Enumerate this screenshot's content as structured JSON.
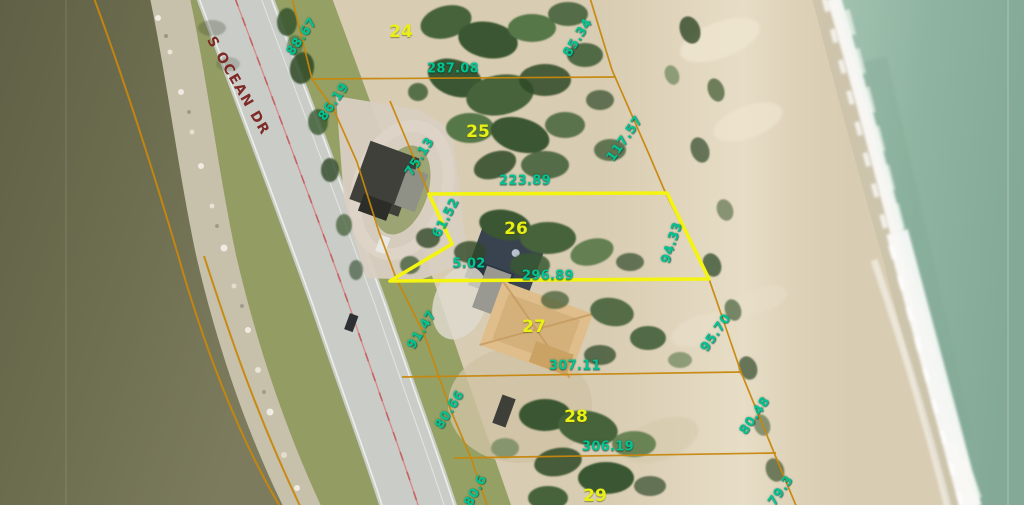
{
  "map": {
    "description": "aerial-parcel-map",
    "selected_parcel": "26"
  },
  "labels": {
    "road": {
      "text": "S OCEAN DR",
      "x": 238,
      "y": 86,
      "rot": 60
    },
    "parcels": [
      {
        "text": "24",
        "x": 401,
        "y": 32
      },
      {
        "text": "25",
        "x": 478,
        "y": 132
      },
      {
        "text": "26",
        "x": 516,
        "y": 229
      },
      {
        "text": "27",
        "x": 534,
        "y": 327
      },
      {
        "text": "28",
        "x": 576,
        "y": 417
      },
      {
        "text": "29",
        "x": 595,
        "y": 496
      }
    ],
    "dimensions": [
      {
        "text": "88.67",
        "x": 302,
        "y": 37,
        "rot": -55
      },
      {
        "text": "86.19",
        "x": 334,
        "y": 102,
        "rot": -55
      },
      {
        "text": "287.08",
        "x": 453,
        "y": 69,
        "rot": 0
      },
      {
        "text": "85.34",
        "x": 578,
        "y": 38,
        "rot": -58
      },
      {
        "text": "117.57",
        "x": 625,
        "y": 139,
        "rot": -55
      },
      {
        "text": "75.13",
        "x": 420,
        "y": 157,
        "rot": -58
      },
      {
        "text": "223.89",
        "x": 525,
        "y": 181,
        "rot": 0
      },
      {
        "text": "61.52",
        "x": 446,
        "y": 218,
        "rot": -62
      },
      {
        "text": "94.33",
        "x": 672,
        "y": 243,
        "rot": -72
      },
      {
        "text": "5.02",
        "x": 469,
        "y": 264,
        "rot": 0
      },
      {
        "text": "296.89",
        "x": 548,
        "y": 276,
        "rot": 0
      },
      {
        "text": "91.47",
        "x": 422,
        "y": 330,
        "rot": -58
      },
      {
        "text": "95.70",
        "x": 716,
        "y": 333,
        "rot": -55
      },
      {
        "text": "307.11",
        "x": 575,
        "y": 366,
        "rot": 0
      },
      {
        "text": "80.66",
        "x": 450,
        "y": 410,
        "rot": -58
      },
      {
        "text": "80.48",
        "x": 755,
        "y": 416,
        "rot": -55
      },
      {
        "text": "306.19",
        "x": 608,
        "y": 447,
        "rot": 0
      },
      {
        "text": "80.6",
        "x": 476,
        "y": 491,
        "rot": -62
      },
      {
        "text": "79.3",
        "x": 781,
        "y": 491,
        "rot": -55
      }
    ]
  },
  "colors": {
    "dimension_text": "#00c492",
    "parcel_text": "#e9f013",
    "boundary_orange": "#c8870d",
    "highlight_yellow": "#f4f411",
    "road_label_color": "#7e2a26"
  }
}
